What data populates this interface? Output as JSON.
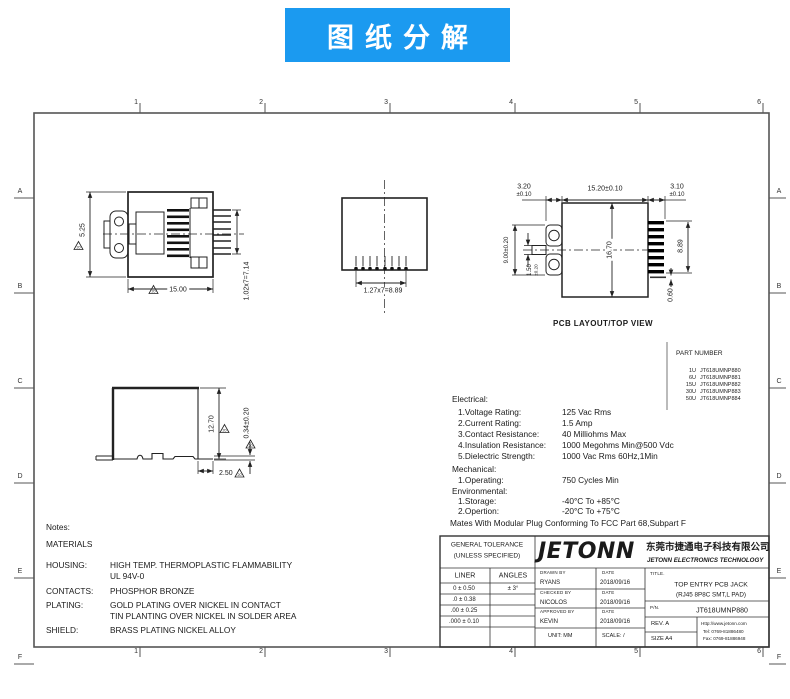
{
  "banner": {
    "title": "图纸分解"
  },
  "colors": {
    "banner": "#1b9af0"
  },
  "frame": {
    "cols": [
      "1",
      "2",
      "3",
      "4",
      "5",
      "6"
    ],
    "rows": [
      "A",
      "B",
      "C",
      "D",
      "E",
      "F"
    ]
  },
  "views": {
    "rev_flag": "20",
    "front": {
      "dim_height": "5.25",
      "dim_width": "15.00",
      "dim_pin_pitch": "1.02x7=7.14"
    },
    "bottom": {
      "dim_pin_pitch": "1.27x7=8.89"
    },
    "pcb": {
      "label": "PCB LAYOUT/TOP VIEW",
      "dim_left_top": "3.20",
      "dim_left_top_tol": "±0.10",
      "dim_mid_top": "15.20±0.10",
      "dim_right_top": "3.10",
      "dim_right_top_tol": "±0.10",
      "dim_pad_span": "9.00±0.20",
      "dim_pad_width": "1.50",
      "dim_pad_width_tol": "±0.20",
      "dim_body": "16.70",
      "dim_pin_span": "8.89",
      "dim_pin_width": "0.60"
    },
    "side": {
      "dim_height": "12.70",
      "dim_standoff": "0.34±0.20",
      "dim_foot": "2.50"
    }
  },
  "part_table": {
    "title": "PART NUMBER",
    "rows": [
      {
        "qty": "1U",
        "pn": "JT618UMNP880"
      },
      {
        "qty": "6U",
        "pn": "JT618UMNP881"
      },
      {
        "qty": "15U",
        "pn": "JT618UMNP882"
      },
      {
        "qty": "30U",
        "pn": "JT618UMNP883"
      },
      {
        "qty": "50U",
        "pn": "JT618UMNP884"
      }
    ]
  },
  "specs": {
    "electrical_title": "Electrical:",
    "electrical": [
      {
        "label": "1.Voltage Rating:",
        "value": "125 Vac Rms"
      },
      {
        "label": "2.Current Rating:",
        "value": "1.5 Amp"
      },
      {
        "label": "3.Contact Resistance:",
        "value": "40 Milliohms Max"
      },
      {
        "label": "4.Insulation Resistance:",
        "value": "1000 Megohms Min@500 Vdc"
      },
      {
        "label": "5.Dielectric Strength:",
        "value": "1000 Vac Rms 60Hz,1Min"
      }
    ],
    "mechanical_title": "Mechanical:",
    "mechanical": [
      {
        "label": "1.Operating:",
        "value": "750 Cycles Min"
      }
    ],
    "environmental_title": "Environmental:",
    "environmental": [
      {
        "label": "1.Storage:",
        "value": "-40°C To +85°C"
      },
      {
        "label": "2.Opertion:",
        "value": "-20°C To +75°C"
      }
    ],
    "footnote": "Mates With Modular Plug Conforming To FCC Part 68,Subpart F"
  },
  "notes": {
    "title": "Notes:",
    "subtitle": "MATERIALS",
    "rows": [
      {
        "label": "HOUSING:",
        "value": "HIGH TEMP. THERMOPLASTIC FLAMMABILITY",
        "value2": "UL 94V-0"
      },
      {
        "label": "CONTACTS:",
        "value": "PHOSPHOR BRONZE",
        "value2": ""
      },
      {
        "label": "PLATING:",
        "value": "GOLD PLATING OVER NICKEL IN CONTACT",
        "value2": "TIN PLANTING OVER NICKEL IN SOLDER AREA"
      },
      {
        "label": "SHIELD:",
        "value": "BRASS PLATING NICKEL ALLOY",
        "value2": ""
      }
    ]
  },
  "titleblock": {
    "tolerance": {
      "header1": "GENERAL TOLERANCE",
      "header2": "(UNLESS SPECIFIED)",
      "col1": "LINER",
      "col2": "ANGLES",
      "rows": [
        "0 ± 0.50",
        ".0 ± 0.38",
        ".00 ± 0.25",
        ".000 ± 0.10"
      ],
      "angle": "± 3°"
    },
    "company": {
      "logo": "JETONN",
      "name_cn": "东莞市捷通电子科技有限公司",
      "name_en": "JETONN ELECTRONICS TECHNOLOGY"
    },
    "sign": {
      "drawn_caption": "DRAWN BY",
      "drawn": "RYANS",
      "checked_caption": "CHECKED BY",
      "checked": "NICOLOS",
      "approved_caption": "APPROVED BY",
      "approved": "KEVIN",
      "date_caption": "DATE",
      "date1": "2018/09/16",
      "date2": "2018/09/16",
      "date3": "2018/09/16",
      "unit": "UNIT: MM",
      "scale": "SCALE: /"
    },
    "title_caption": "TITLE.",
    "title1": "TOP ENTRY PCB JACK",
    "title2": "(RJ45 8P8C SMT,L PAD)",
    "pn_caption": "P/N.",
    "pn": "JT618UMNP880",
    "rev": "REV. A",
    "size": "SIZE A4",
    "web": "Http://www.jetonn.com",
    "tel": "Tel: 0769-81886480",
    "fax": "Fax: 0769-81886948"
  }
}
